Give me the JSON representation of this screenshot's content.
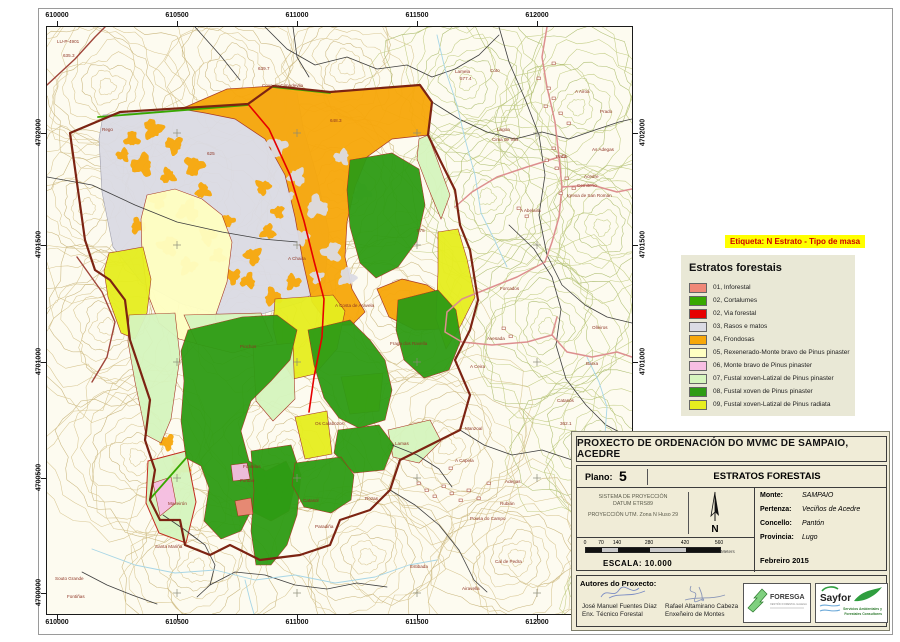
{
  "map": {
    "x_ticks": [
      "610000",
      "610500",
      "611000",
      "611500",
      "612000"
    ],
    "x_tick_px": [
      57,
      177,
      297,
      417,
      537
    ],
    "y_ticks_left": [
      "4702000",
      "4701500",
      "4701000",
      "4700500",
      "4700000"
    ],
    "y_ticks_right": [
      "4702000",
      "4701500",
      "4701000"
    ],
    "y_tick_px": [
      133,
      245,
      362,
      478,
      593
    ],
    "place_labels": [
      {
        "t": "LU-P-4901",
        "x": 10,
        "y": 16
      },
      {
        "t": "Rego",
        "x": 55,
        "y": 104
      },
      {
        "t": "635.3",
        "x": 16,
        "y": 30
      },
      {
        "t": "639.7",
        "x": 211,
        "y": 43
      },
      {
        "t": "648.3",
        "x": 283,
        "y": 95
      },
      {
        "t": "625",
        "x": 160,
        "y": 128
      },
      {
        "t": "575",
        "x": 370,
        "y": 205
      },
      {
        "t": "362.1",
        "x": 513,
        "y": 398
      },
      {
        "t": "Cova da Cimadevila",
        "x": 215,
        "y": 60
      },
      {
        "t": "A Chaira",
        "x": 241,
        "y": 233
      },
      {
        "t": "A Costa de Aravela",
        "x": 288,
        "y": 280
      },
      {
        "t": "Fraga dos Ravella",
        "x": 343,
        "y": 318
      },
      {
        "t": "Piochos",
        "x": 193,
        "y": 321
      },
      {
        "t": "Os Calabozos",
        "x": 268,
        "y": 398
      },
      {
        "t": "Fontelas",
        "x": 196,
        "y": 441
      },
      {
        "t": "Maceirón",
        "x": 121,
        "y": 478
      },
      {
        "t": "Santa Mariña",
        "x": 108,
        "y": 521
      },
      {
        "t": "Souto Grande",
        "x": 8,
        "y": 553
      },
      {
        "t": "Fontiñas",
        "x": 20,
        "y": 571
      },
      {
        "t": "Lamela",
        "x": 408,
        "y": 46
      },
      {
        "t": "577.4",
        "x": 413,
        "y": 53
      },
      {
        "t": "Coto",
        "x": 443,
        "y": 45
      },
      {
        "t": "Lagoa",
        "x": 450,
        "y": 104
      },
      {
        "t": "Cima de Vila",
        "x": 445,
        "y": 114
      },
      {
        "t": "A Airoá",
        "x": 528,
        "y": 66
      },
      {
        "t": "Prado",
        "x": 553,
        "y": 86
      },
      {
        "t": "Pacio",
        "x": 509,
        "y": 131
      },
      {
        "t": "As Adegas",
        "x": 545,
        "y": 124
      },
      {
        "t": "Acedre",
        "x": 537,
        "y": 151
      },
      {
        "t": "Cemiterio",
        "x": 530,
        "y": 160
      },
      {
        "t": "Igrexa de San Román",
        "x": 520,
        "y": 170
      },
      {
        "t": "A Abelaira",
        "x": 473,
        "y": 185
      },
      {
        "t": "Forcados",
        "x": 453,
        "y": 263
      },
      {
        "t": "Avesada",
        "x": 440,
        "y": 313
      },
      {
        "t": "A Ceira",
        "x": 423,
        "y": 341
      },
      {
        "t": "Barxa",
        "x": 539,
        "y": 338
      },
      {
        "t": "Olleiros",
        "x": 545,
        "y": 302
      },
      {
        "t": "Catasós",
        "x": 510,
        "y": 375
      },
      {
        "t": "Lamas",
        "x": 348,
        "y": 418
      },
      {
        "t": "Manzoal",
        "x": 418,
        "y": 403
      },
      {
        "t": "A Capela",
        "x": 408,
        "y": 435
      },
      {
        "t": "Adegas",
        "x": 458,
        "y": 456
      },
      {
        "t": "Rubián",
        "x": 453,
        "y": 478
      },
      {
        "t": "Pousa do Campo",
        "x": 423,
        "y": 493
      },
      {
        "t": "Estibada",
        "x": 363,
        "y": 541
      },
      {
        "t": "Cal de Pedra",
        "x": 448,
        "y": 536
      },
      {
        "t": "Airavella",
        "x": 415,
        "y": 563
      },
      {
        "t": "Paradiña",
        "x": 268,
        "y": 501
      },
      {
        "t": "Rozas",
        "x": 318,
        "y": 473
      },
      {
        "t": "Fontao",
        "x": 193,
        "y": 455
      },
      {
        "t": "Catasol",
        "x": 256,
        "y": 475
      }
    ]
  },
  "etiqueta": {
    "label": "Etiqueta: N Estrato - Tipo de masa"
  },
  "legend": {
    "title": "Estratos forestais",
    "items": [
      {
        "label": "01, Inforestal",
        "color": "#F08878"
      },
      {
        "label": "02, Cortalumes",
        "color": "#38A800"
      },
      {
        "label": "02, Via forestal",
        "color": "#E60000"
      },
      {
        "label": "03, Rasos e matos",
        "color": "#DBDBE4"
      },
      {
        "label": "04, Frondosas",
        "color": "#F7A70A"
      },
      {
        "label": "05, Rexenerado-Monte bravo de Pinus pinaster",
        "color": "#FFFFC2"
      },
      {
        "label": "06, Monte bravo de Pinus pinaster",
        "color": "#F7BEE3"
      },
      {
        "label": "07, Fustal xoven-Latizal de Pinus pinaster",
        "color": "#D6F5BE"
      },
      {
        "label": "08, Fustal xoven de Pinus pinaster",
        "color": "#2E9C14"
      },
      {
        "label": "09, Fustal xoven-Latizal de Pinus radiata",
        "color": "#E6EE1F"
      }
    ]
  },
  "title_block": {
    "title": "PROXECTO DE ORDENACIÓN DO MVMC DE SAMPAIO, ACEDRE",
    "plano_label": "Plano:",
    "plano_number": "5",
    "map_name": "ESTRATOS FORESTAIS",
    "projection_lines": [
      "SISTEMA DE PROYECCIÓN",
      "DATUM ETRS89",
      "PROYECCIÓN UTM. Zona N Huso 29"
    ],
    "north_label": "N",
    "fields": [
      {
        "label": "Monte:",
        "value": "SAMPAIO"
      },
      {
        "label": "Pertenza:",
        "value": "Veciños de Acedre"
      },
      {
        "label": "Concello:",
        "value": "Pantón"
      },
      {
        "label": "Provincia:",
        "value": "Lugo"
      }
    ],
    "date": "Febreiro 2015",
    "scale_ticks": [
      "0",
      "70",
      "140",
      "280",
      "420",
      "560"
    ],
    "scale_tick_px": [
      0,
      16,
      32,
      64,
      100,
      134
    ],
    "scale_unit": "Meters",
    "escala": "ESCALA:  10.000"
  },
  "authors": {
    "heading": "Autores do Proxecto:",
    "entries": [
      {
        "name": "José Manuel Fuentes Díaz",
        "role": "Enx. Técnico Forestal"
      },
      {
        "name": "Rafael Altamirano Cabeza",
        "role": "Enxeñeiro de Montes"
      }
    ]
  },
  "logos": {
    "foresga": {
      "name": "FORESGA",
      "tagline": "XESTIÓN FORESTAL GALEGA"
    },
    "sayfor": {
      "name": "Sayfor",
      "tagline1": "Servicios Ambientales y",
      "tagline2": "Forestales Consultores"
    }
  }
}
